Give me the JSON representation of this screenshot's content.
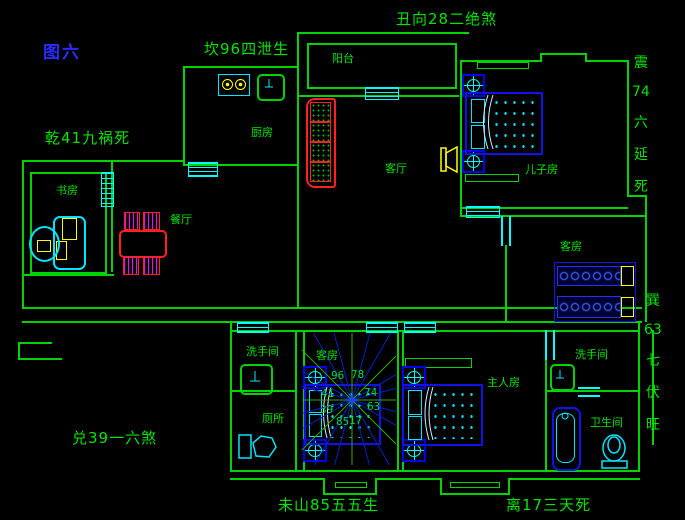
{
  "figure_title": {
    "text": "图六",
    "color": "#2b2bff"
  },
  "fengshui_labels": {
    "top_center": "丑向28二绝煞",
    "upper_left": "坎96四泄生",
    "mid_left": "乾41九祸死",
    "lower_left": "兑39一六煞",
    "bottom_left": "未山85五五生",
    "bottom_right": "离17三天死",
    "right_upper_chars": [
      "震",
      "74",
      "六",
      "延",
      "死"
    ],
    "right_lower_chars": [
      "巽",
      "63",
      "七",
      "伏",
      "旺"
    ]
  },
  "rooms": {
    "balcony": "阳台",
    "kitchen": "厨房",
    "living": "客厅",
    "son_room": "儿子房",
    "study": "书房",
    "dining": "餐厅",
    "guest_right": "客房",
    "washroom_left": "洗手间",
    "toilet_left": "厕所",
    "guest_mid": "客房",
    "master": "主人房",
    "washroom_right": "洗手间",
    "bathroom_right": "卫生间"
  },
  "luopan": {
    "center": {
      "x": 352,
      "y": 400
    },
    "bounds": {
      "x1": 302,
      "y1": 333,
      "x2": 396,
      "y2": 465
    },
    "line_count": 24,
    "numbers": [
      {
        "value": "96",
        "x": 331,
        "y": 369
      },
      {
        "value": "78",
        "x": 351,
        "y": 368
      },
      {
        "value": "74",
        "x": 364,
        "y": 386
      },
      {
        "value": "63",
        "x": 367,
        "y": 400
      },
      {
        "value": "17",
        "x": 349,
        "y": 414
      },
      {
        "value": "85",
        "x": 336,
        "y": 415
      },
      {
        "value": "41",
        "x": 321,
        "y": 387
      },
      {
        "value": "39",
        "x": 320,
        "y": 403
      }
    ]
  },
  "colors": {
    "wall_green": "#00d400",
    "text_green": "#00e400",
    "window_cyan": "#00ffff",
    "furniture_blue": "#1111ee",
    "luopan_blue": "#0022cc",
    "luopan_green": "#2fae00",
    "accent_red": "#ff2020",
    "accent_magenta": "#ff00ff",
    "accent_yellow": "#ffff00",
    "figure_blue": "#2b2bff",
    "background": "#000000"
  }
}
